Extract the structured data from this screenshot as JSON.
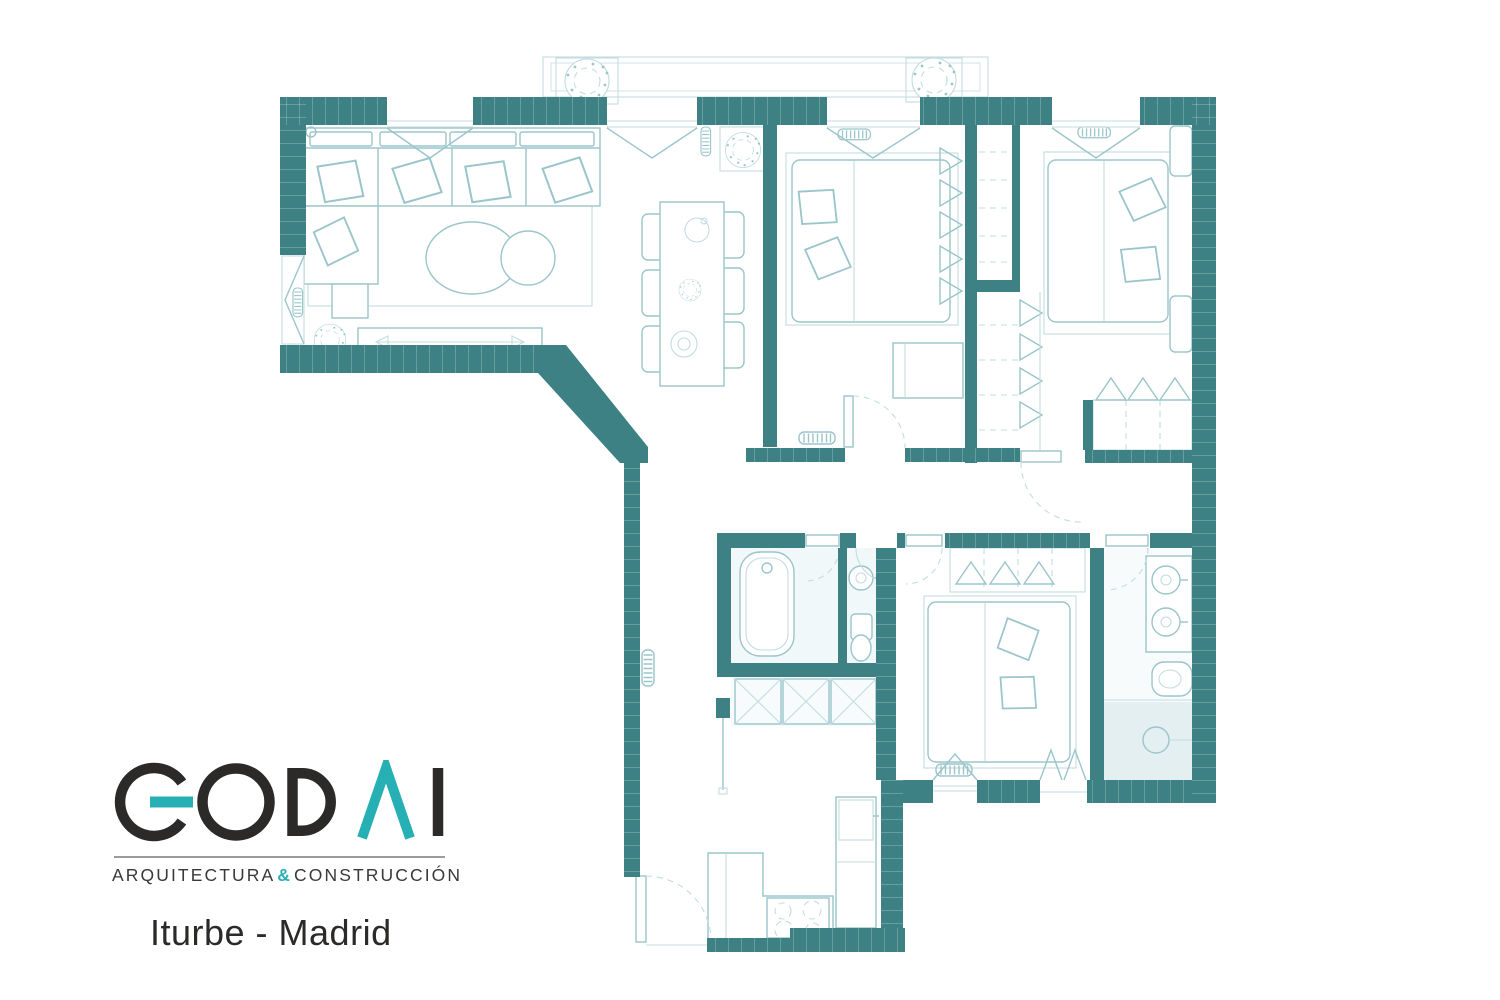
{
  "brand": {
    "name": "GODAI",
    "tagline_left": "ARQUITECTURA",
    "tagline_amp": "&",
    "tagline_right": "CONSTRUCCIÓN",
    "project": "Iturbe - Madrid"
  },
  "colors": {
    "wall": "#3e8184",
    "line": "#9ac5cb",
    "line-light": "#c2dce1",
    "floor": "#f1f8f9",
    "floor-lighter": "#f7fbfc",
    "floor-dark": "#e4eff1",
    "ink": "#2b2a29",
    "accent": "#27b0b4",
    "rule": "#9b9b9b"
  },
  "plan": {
    "type": "apartment-floor-plan",
    "rooms": [
      "living-dining-room",
      "bedroom-1",
      "bedroom-2",
      "master-bedroom",
      "bathroom",
      "wc",
      "ensuite-bathroom",
      "kitchen",
      "hallway",
      "laundry-closet",
      "built-in-wardrobes",
      "balcony"
    ],
    "fixtures": [
      "sofa",
      "chaise",
      "rug",
      "coffee-tables",
      "tv-console",
      "dining-table",
      "six-chairs",
      "double-beds",
      "pillows",
      "wardrobe-hangers",
      "bathtub",
      "wash-basins",
      "toilet",
      "bidet",
      "shower",
      "kitchen-counter",
      "cooktop",
      "sink",
      "radiators",
      "plants",
      "door-swings",
      "windows"
    ]
  }
}
